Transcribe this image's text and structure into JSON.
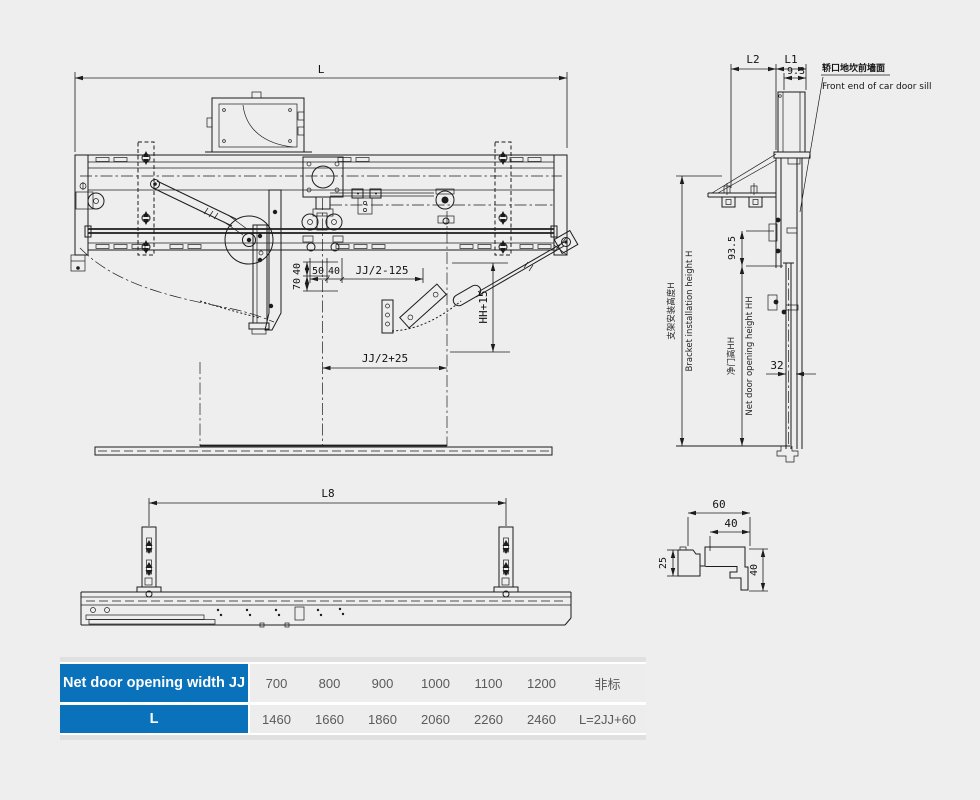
{
  "page": {
    "background": "#eeeeee",
    "line_color": "#1c1c1c"
  },
  "front_view": {
    "dim_l": "L",
    "dim_v40": "40",
    "dim_v70": "70",
    "dim_50": "50",
    "dim_40": "40",
    "dim_jj_minus": "JJ/2-125",
    "dim_jj_plus": "JJ/2+25",
    "dim_hh15": "HH+15"
  },
  "side_view": {
    "dim_l2": "L2",
    "dim_l1": "L1",
    "dim_9_3": "9.3",
    "dim_93_5": "93.5",
    "dim_32": "32",
    "sill_label_cn": "轿口地坎前墙面",
    "sill_label_en": "Front end of car door sill",
    "height_label_cn": "支架安装高度H",
    "height_label_en": "Bracket installation height H",
    "opening_label_cn": "净门高HH",
    "opening_label_en": "Net door opening height HH"
  },
  "bottom_view": {
    "dim_l8": "L8"
  },
  "section_view": {
    "dim_60": "60",
    "dim_40_top": "40",
    "dim_25": "25",
    "dim_40_side": "40"
  },
  "table": {
    "header_bg": "#0a72ba",
    "rows": [
      {
        "label": "Net door opening width JJ",
        "values": [
          "700",
          "800",
          "900",
          "1000",
          "1100",
          "1200",
          "非标"
        ]
      },
      {
        "label": "L",
        "values": [
          "1460",
          "1660",
          "1860",
          "2060",
          "2260",
          "2460",
          "L=2JJ+60"
        ]
      }
    ]
  }
}
